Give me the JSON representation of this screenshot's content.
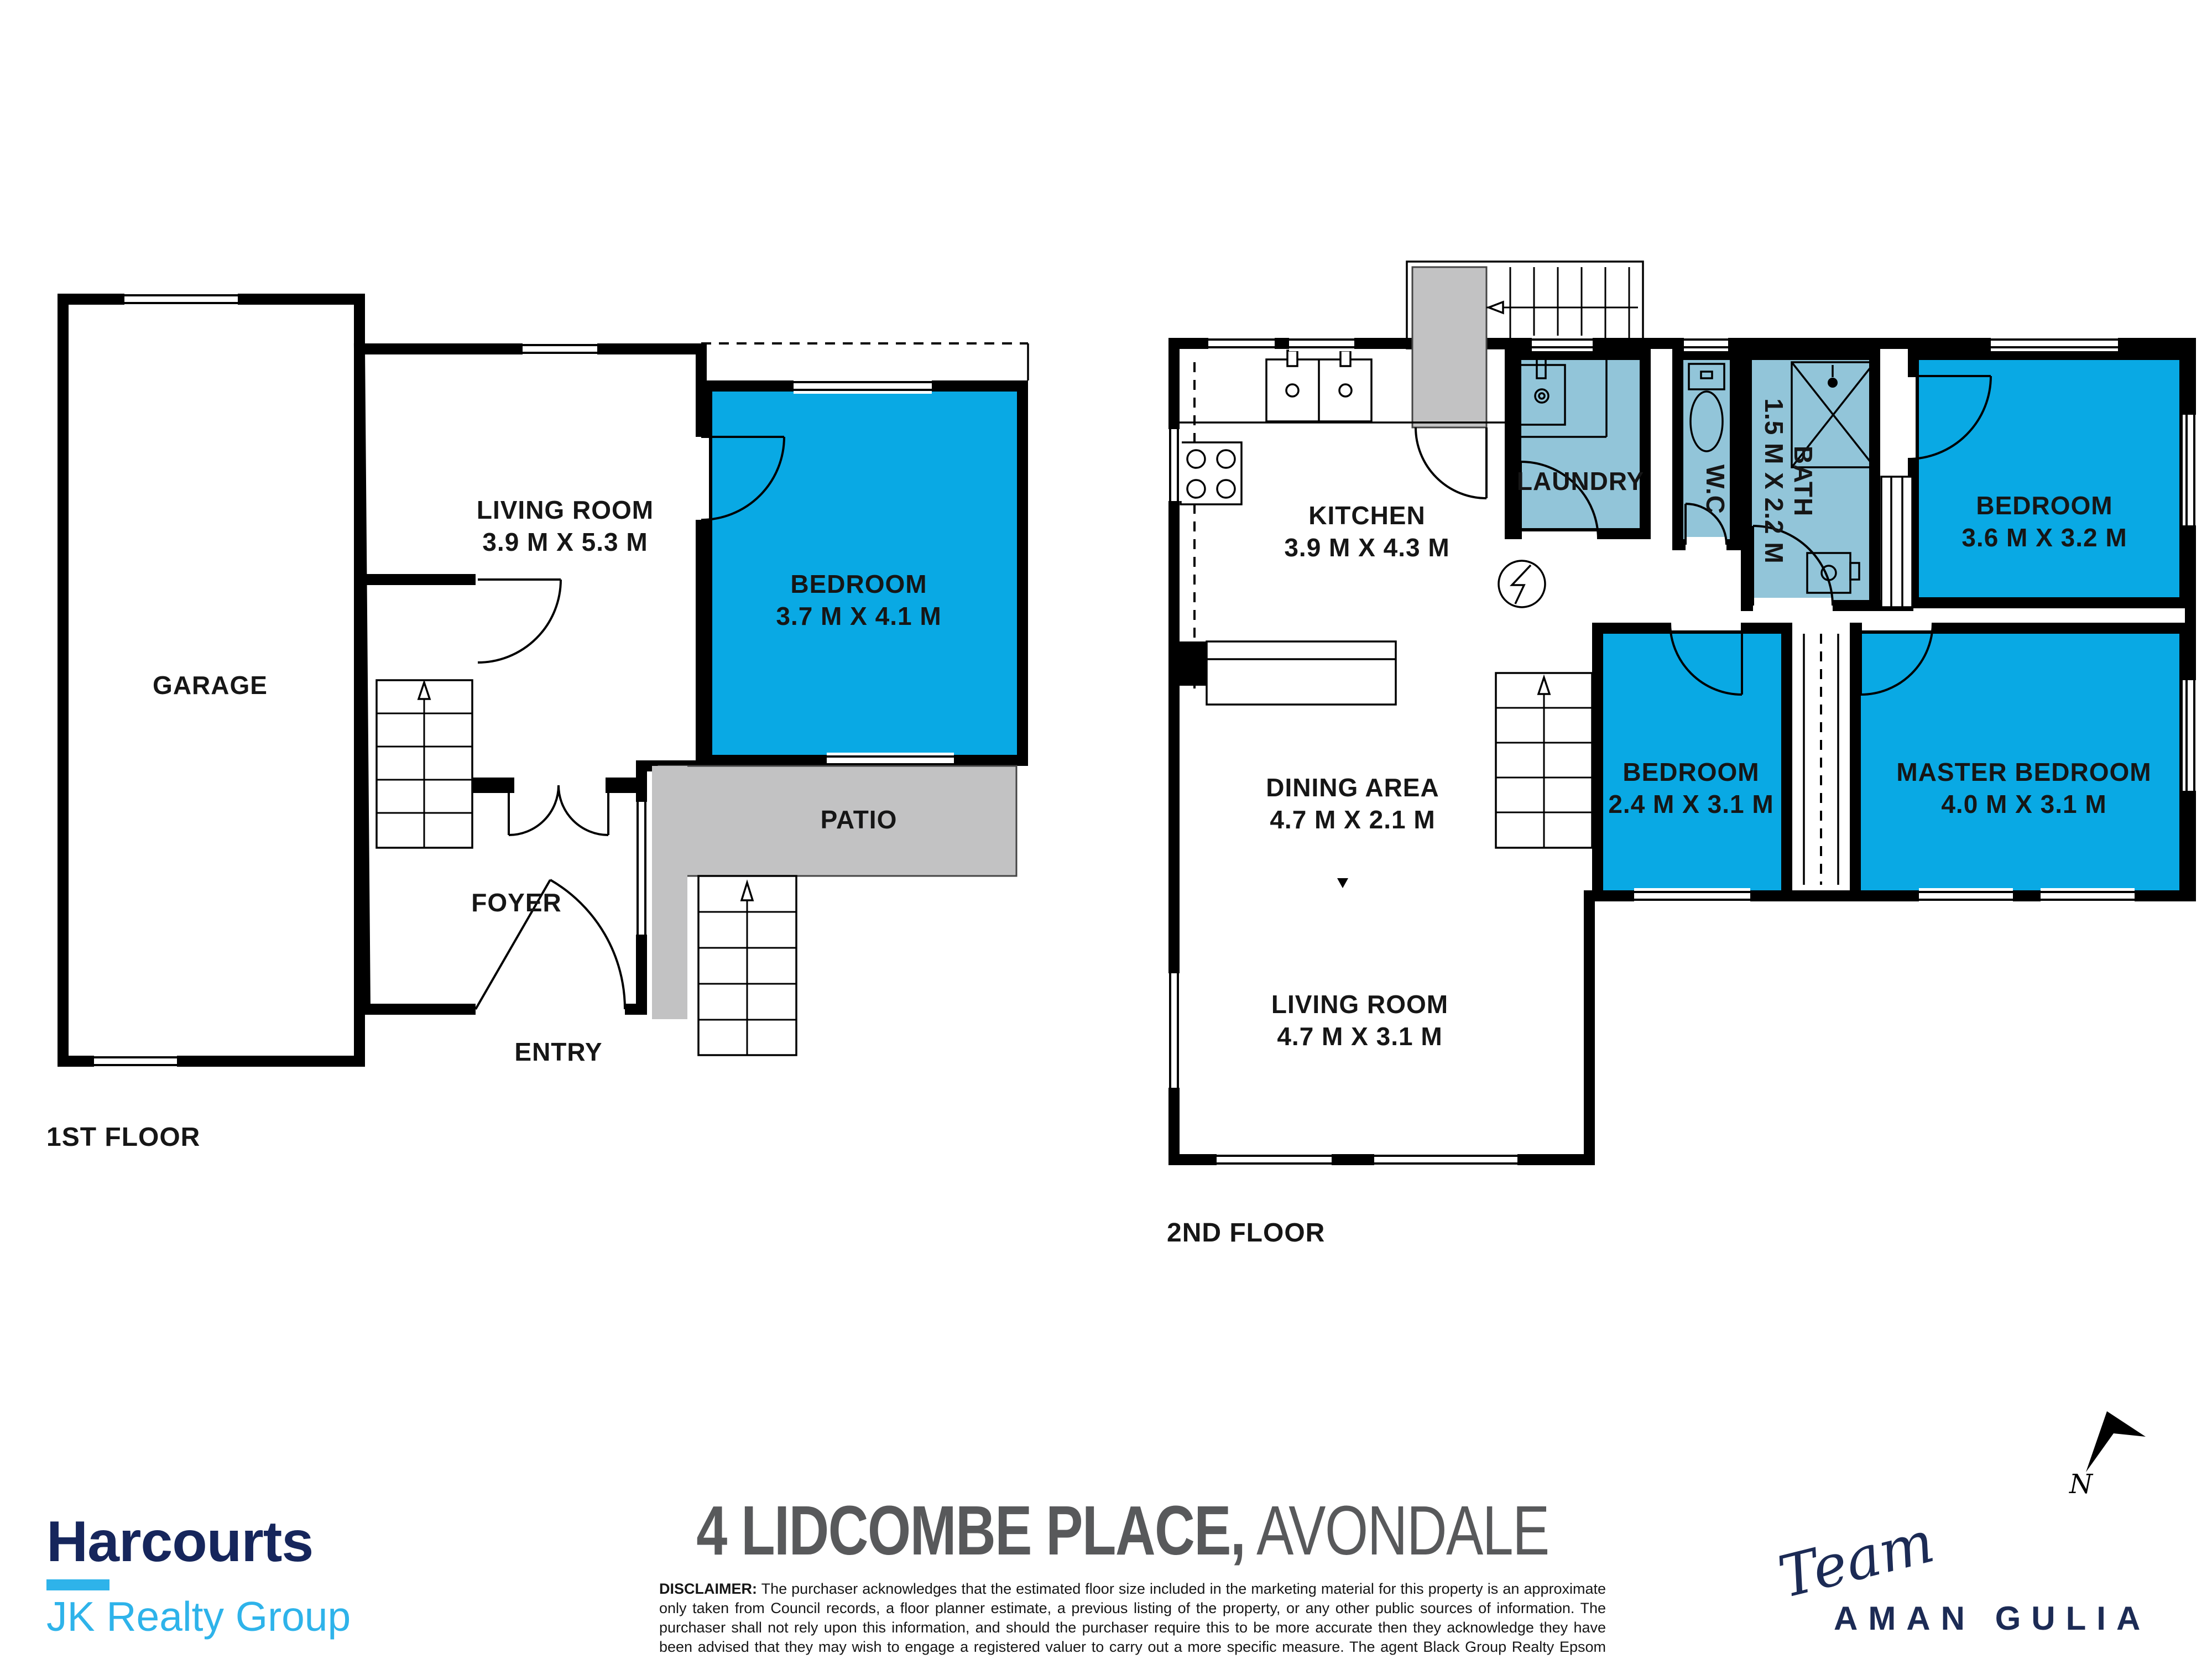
{
  "floor1": {
    "label": "1ST FLOOR",
    "rooms": {
      "garage": {
        "name": "GARAGE"
      },
      "living": {
        "name": "LIVING ROOM",
        "dims": "3.9 M X 5.3 M"
      },
      "bedroom": {
        "name": "BEDROOM",
        "dims": "3.7 M X 4.1 M"
      },
      "patio": {
        "name": "PATIO"
      },
      "foyer": {
        "name": "FOYER"
      },
      "entry": {
        "name": "ENTRY"
      }
    }
  },
  "floor2": {
    "label": "2ND FLOOR",
    "rooms": {
      "kitchen": {
        "name": "KITCHEN",
        "dims": "3.9 M X 4.3 M"
      },
      "laundry": {
        "name": "LAUNDRY"
      },
      "wc": {
        "name": "W.C"
      },
      "bath": {
        "name": "BATH",
        "dims": "1.5 M X 2.2 M"
      },
      "bedroom1": {
        "name": "BEDROOM",
        "dims": "3.6 M X 3.2 M"
      },
      "bedroom2": {
        "name": "BEDROOM",
        "dims": "2.4 M X 3.1 M"
      },
      "master": {
        "name": "MASTER BEDROOM",
        "dims": "4.0 M X 3.1 M"
      },
      "dining": {
        "name": "DINING AREA",
        "dims": "4.7 M X 2.1 M"
      },
      "living": {
        "name": "LIVING ROOM",
        "dims": "4.7 M X 3.1 M"
      }
    }
  },
  "footer": {
    "address_bold": "4 LIDCOMBE PLACE,",
    "address_light": "AVONDALE",
    "brand_name": "Harcourts",
    "brand_sub": "JK Realty Group",
    "team_script": "Team",
    "team_name": "AMAN GULIA",
    "compass_label": "N",
    "disclaimer_label": "DISCLAIMER:",
    "disclaimer_text": " The purchaser acknowledges that the estimated floor size included in the marketing material for this property is an approximate only taken from Council records, a floor planner estimate, a previous listing of the property, or any other public sources of information.  The purchaser shall not rely upon this information, and should the purchaser require this to be more accurate then they acknowledge they have been advised that they may wish to engage a registered valuer to carry out a more specific measure.  The agent Black Group Realty Epsom Limited (or Matakana Limited) has taken all reasonable steps to ensure the accuracy of the information provided and the purchaser shall not make any claim in relation to inaccuracy of the same."
  },
  "colors": {
    "bedroom_blue": "#09A9E4",
    "wet_blue": "#92C5D9",
    "patio_grey": "#C2C2C3",
    "wall_black": "#000000",
    "title_grey": "#58595B",
    "brand_navy": "#16265C",
    "brand_cyan": "#2EB3EA",
    "team_navy": "#1C2B55"
  }
}
